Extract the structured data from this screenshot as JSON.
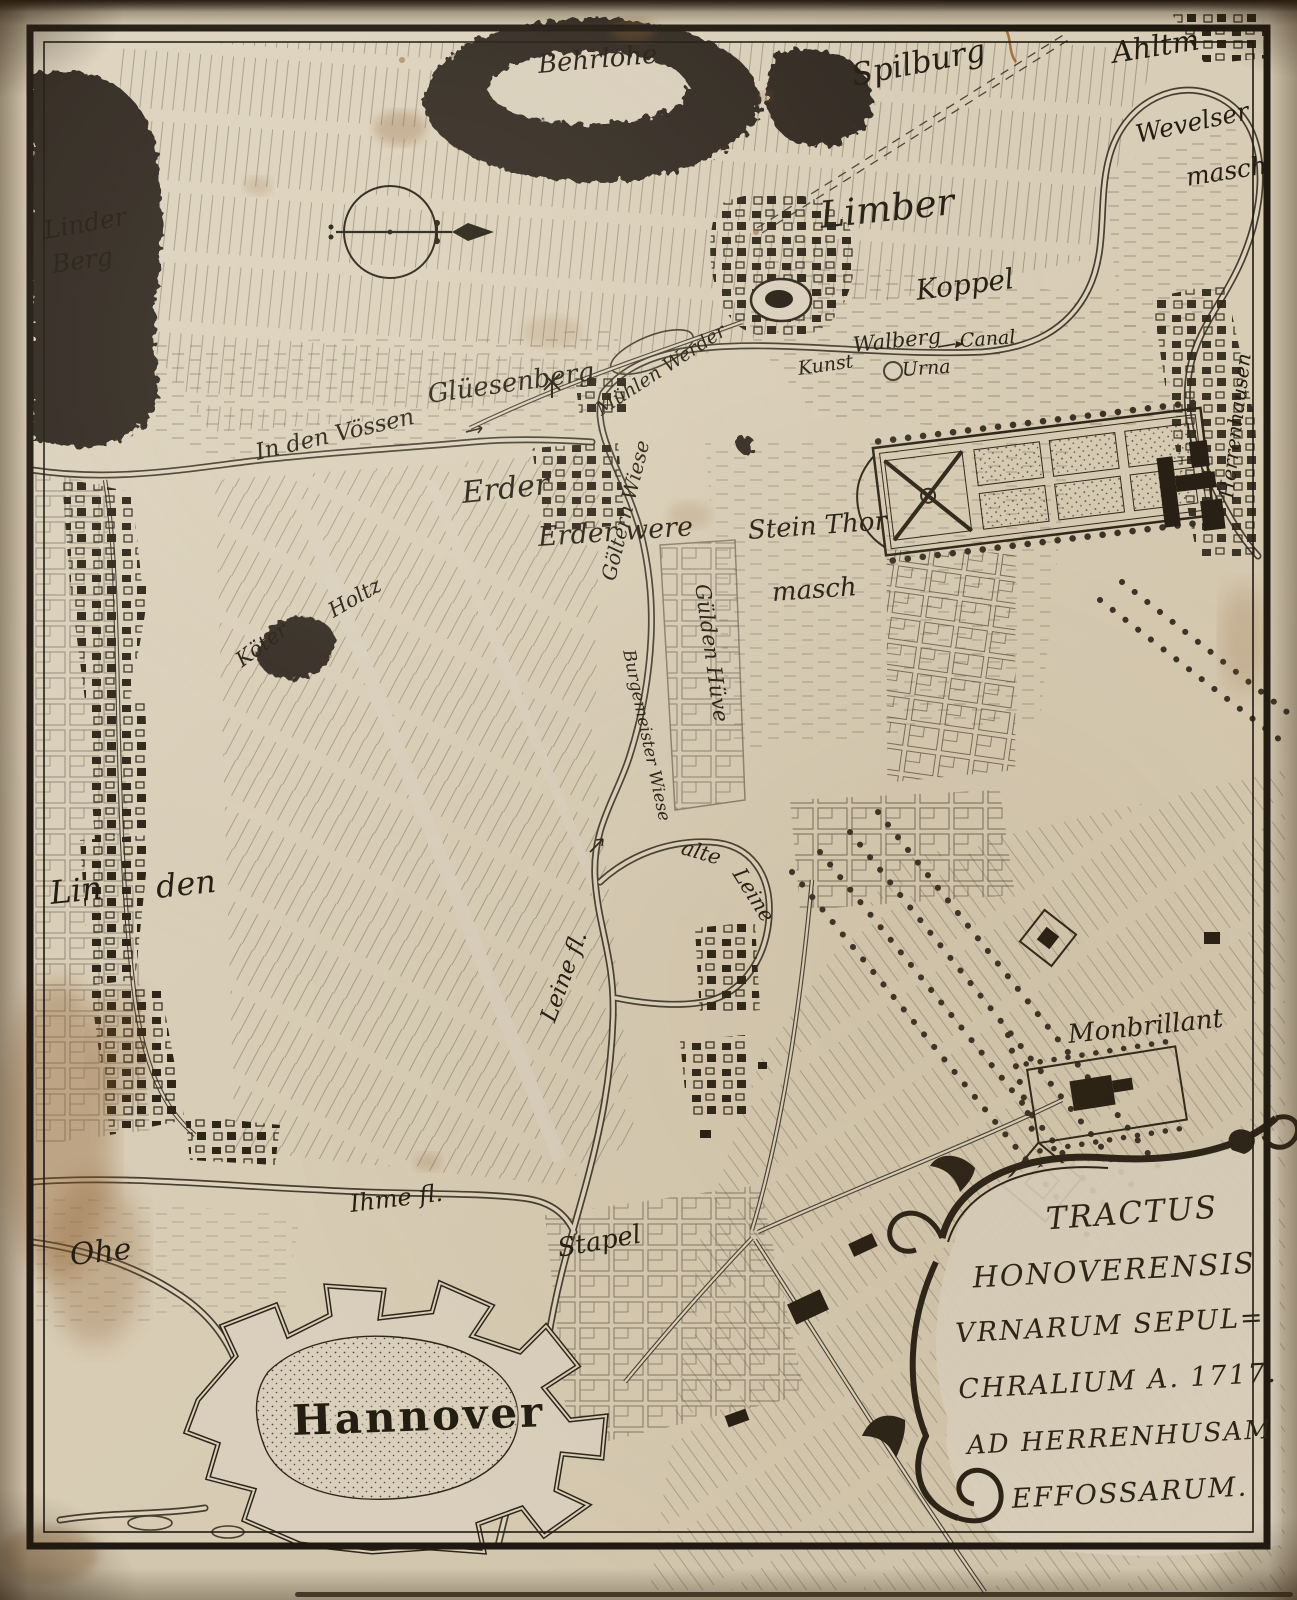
{
  "colors": {
    "paper": "#d8cdb8",
    "paper_light": "#ddd3bf",
    "ink": "#2b241b",
    "stain": "#8a5a2a"
  },
  "icons": {
    "compass": "compass-rose-icon",
    "windmill": "windmill-icon"
  },
  "labels": [
    {
      "id": "behrlohe",
      "text": "Behrlohe"
    },
    {
      "id": "spilburg",
      "text": "Spilburg"
    },
    {
      "id": "ahltm",
      "text": "Ahltm"
    },
    {
      "id": "wevelser",
      "text": "Wevelser"
    },
    {
      "id": "wevelser-masch",
      "text": "masch"
    },
    {
      "id": "linder",
      "text": "Linder"
    },
    {
      "id": "berg",
      "text": "Berg"
    },
    {
      "id": "limber",
      "text": "Limber"
    },
    {
      "id": "koppel",
      "text": "Koppel"
    },
    {
      "id": "walberg",
      "text": "Walberg"
    },
    {
      "id": "kunst",
      "text": "Kunst"
    },
    {
      "id": "urna",
      "text": "Urna"
    },
    {
      "id": "canal",
      "text": "Canal"
    },
    {
      "id": "herrenhausen",
      "text": "Herrenhausen"
    },
    {
      "id": "muhlen-werder",
      "text": "Mühlen Werder"
    },
    {
      "id": "gliesenberg",
      "text": "Glüesenberg"
    },
    {
      "id": "in-den-vossen",
      "text": "In den Vössen"
    },
    {
      "id": "erder",
      "text": "Erder"
    },
    {
      "id": "erder-were",
      "text": "Erder were"
    },
    {
      "id": "goltern-wiese",
      "text": "Göltern Wiese"
    },
    {
      "id": "stein-thor",
      "text": "Stein Thor"
    },
    {
      "id": "stein-thor-masch",
      "text": "masch"
    },
    {
      "id": "koter",
      "text": "Köter"
    },
    {
      "id": "holtz",
      "text": "Holtz"
    },
    {
      "id": "gulden-huve",
      "text": "Gülden Hüve"
    },
    {
      "id": "burgemeister-wiese",
      "text": "Burgemeister Wiese"
    },
    {
      "id": "alte",
      "text": "alte"
    },
    {
      "id": "leine-alt",
      "text": "Leine"
    },
    {
      "id": "leine-fl",
      "text": "Leine fl."
    },
    {
      "id": "lin",
      "text": "Lin"
    },
    {
      "id": "den",
      "text": "den"
    },
    {
      "id": "monbrillant",
      "text": "Monbrillant"
    },
    {
      "id": "ihme-fl",
      "text": "Ihme fl."
    },
    {
      "id": "ohe",
      "text": "Ohe"
    },
    {
      "id": "stapel",
      "text": "Stapel"
    },
    {
      "id": "hannover",
      "text": "Hannover"
    }
  ],
  "cartouche": {
    "lines": [
      "TRACTUS",
      "HONOVERENSIS",
      "VRNARUM SEPUL=",
      "CHRALIUM A. 1717.",
      "AD HERRENHUSAM",
      "EFFOSSARUM."
    ]
  }
}
